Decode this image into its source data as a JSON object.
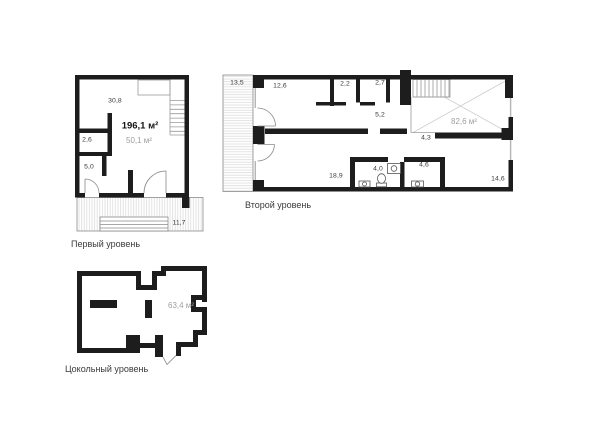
{
  "colors": {
    "wall": "#1d1d1d",
    "thin_line": "#9a9a9a",
    "hatch": "#dcdcdc",
    "void_cross": "#cccccc",
    "area_gray": "#9e9e9e",
    "text": "#3a3a3a"
  },
  "plans": {
    "first": {
      "caption": "Первый уровень",
      "area_total": "196,1 м²",
      "area_secondary": "50,1 м²",
      "rooms": {
        "room1": "30,8",
        "room2": "2,6",
        "room3": "5,0",
        "terrace": "11,7"
      }
    },
    "second": {
      "caption": "Второй уровень",
      "area_void": "82,6 м²",
      "rooms": {
        "terrace": "13,5",
        "room1": "12,6",
        "room2": "2,2",
        "room3": "2,7",
        "hall": "5,2",
        "corridor": "4,3",
        "room4": "18,9",
        "bath1": "4,0",
        "bath2": "4,6",
        "room5": "14,6"
      }
    },
    "basement": {
      "caption": "Цокольный уровень",
      "area": "63,4 м²"
    }
  }
}
